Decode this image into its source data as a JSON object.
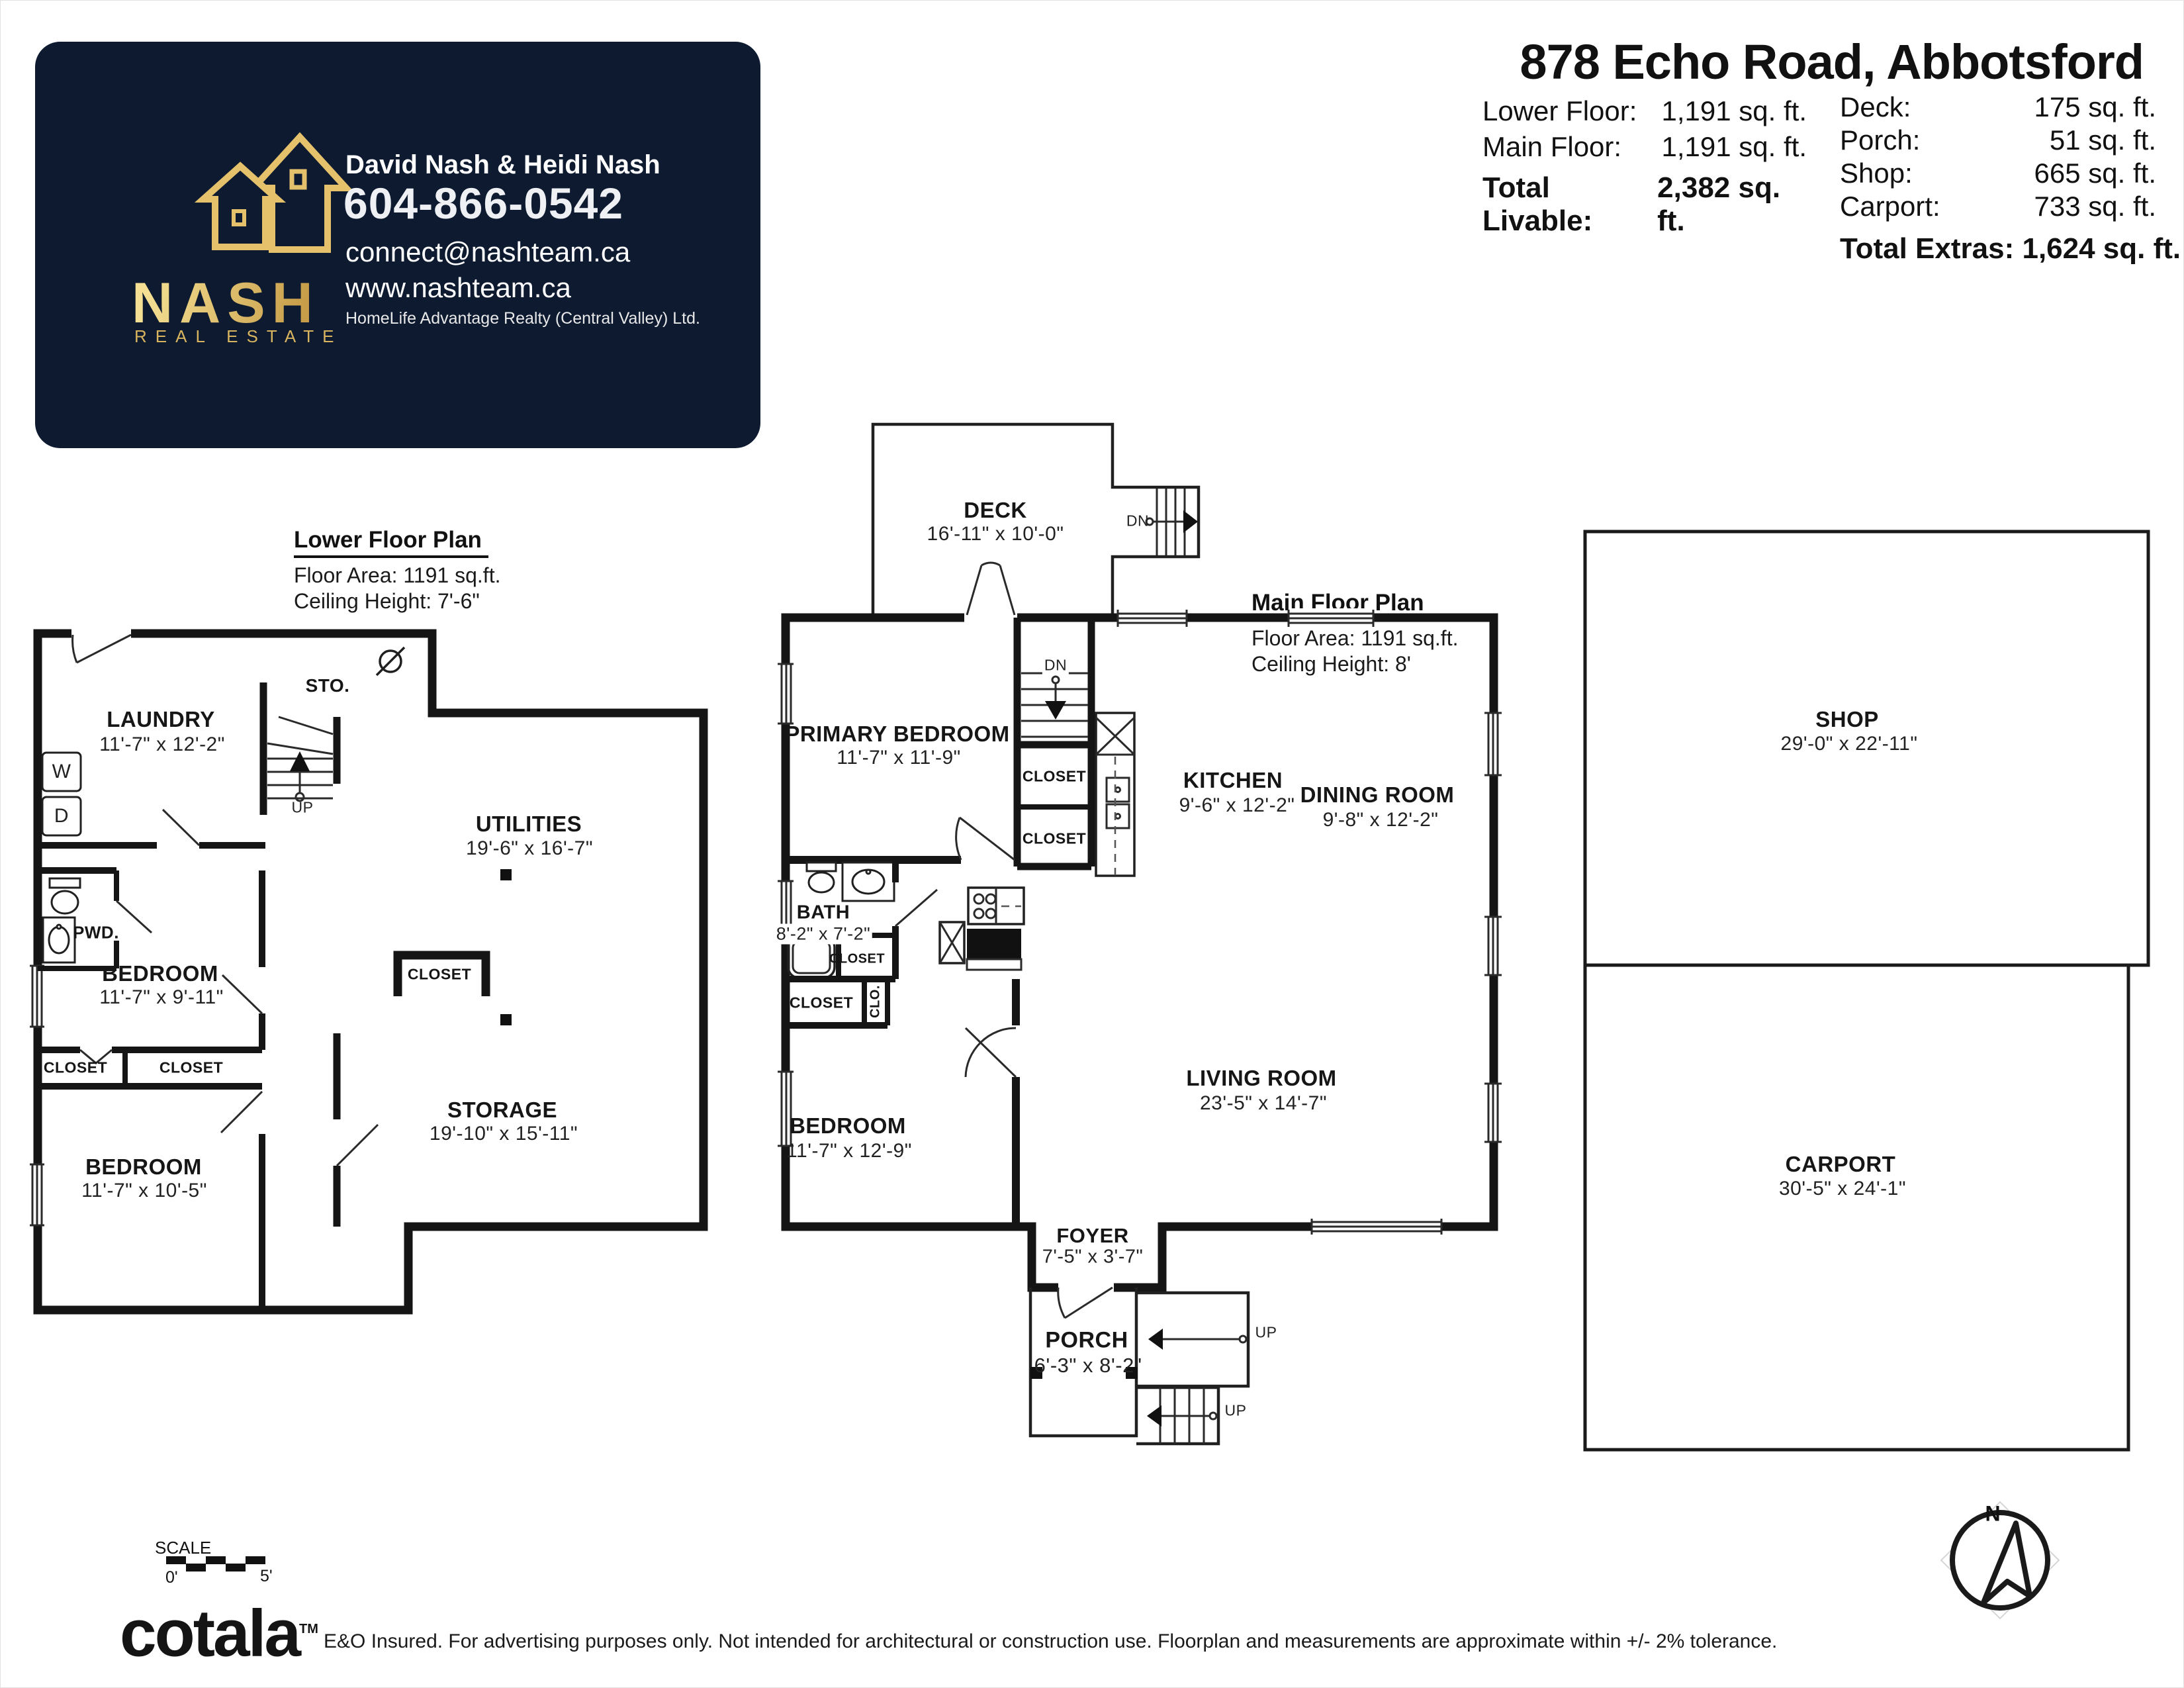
{
  "header": {
    "title": "878 Echo Road, Abbotsford",
    "left_rows": [
      {
        "label": "Lower Floor:",
        "value": "1,191 sq. ft."
      },
      {
        "label": "Main Floor:",
        "value": "1,191 sq. ft."
      }
    ],
    "total_livable_label": "Total Livable:",
    "total_livable_value": "2,382 sq. ft.",
    "right_rows": [
      {
        "label": "Deck:",
        "value": "175 sq. ft."
      },
      {
        "label": "Porch:",
        "value": "51 sq. ft."
      },
      {
        "label": "Shop:",
        "value": "665 sq. ft."
      },
      {
        "label": "Carport:",
        "value": "733 sq. ft."
      }
    ],
    "total_extras": "Total Extras: 1,624 sq. ft."
  },
  "card": {
    "brand": "NASH",
    "brand_sub": "REAL ESTATE",
    "agents": "David Nash & Heidi Nash",
    "phone": "604-866-0542",
    "email": "connect@nashteam.ca",
    "website": "www.nashteam.ca",
    "brokerage": "HomeLife Advantage Realty (Central Valley) Ltd.",
    "bg_color": "#0d1a30",
    "gold_color": "#d9b45f"
  },
  "lower_plan": {
    "title": "Lower Floor Plan",
    "area": "Floor Area: 1191 sq.ft.",
    "ceiling": "Ceiling Height: 7'-6\"",
    "labels": {
      "sto": "STO.",
      "laundry": "LAUNDRY",
      "laundry_dims": "11'-7\" x 12'-2\"",
      "washer": "W",
      "dryer": "D",
      "up": "UP",
      "pwd": "PWD.",
      "bedroom1": "BEDROOM",
      "bedroom1_dims": "11'-7\" x 9'-11\"",
      "closet_left": "CLOSET",
      "closet_right": "CLOSET",
      "bedroom2": "BEDROOM",
      "bedroom2_dims": "11'-7\" x 10'-5\"",
      "utilities": "UTILITIES",
      "utilities_dims": "19'-6\" x 16'-7\"",
      "closet_center": "CLOSET",
      "storage": "STORAGE",
      "storage_dims": "19'-10\" x 15'-11\""
    }
  },
  "main_plan": {
    "title": "Main Floor Plan",
    "area": "Floor Area: 1191 sq.ft.",
    "ceiling": "Ceiling Height: 8'",
    "labels": {
      "deck": "DECK",
      "deck_dims": "16'-11\" x 10'-0\"",
      "dn_deck": "DN",
      "dn_stairs": "DN",
      "primary": "PRIMARY BEDROOM",
      "primary_dims": "11'-7\" x 11'-9\"",
      "closet_upper": "CLOSET",
      "closet_lower": "CLOSET",
      "kitchen": "KITCHEN",
      "kitchen_dims": "9'-6\" x 12'-2\"",
      "dining": "DINING ROOM",
      "dining_dims": "9'-8\" x 12'-2\"",
      "bath": "BATH",
      "bath_dims": "8'-2\" x 7'-2\"",
      "closet_bath": "CLOSET",
      "closet_hall": "CLOSET",
      "clo": "CLO.",
      "bedroom": "BEDROOM",
      "bedroom_dims": "11'-7\" x 12'-9\"",
      "living": "LIVING ROOM",
      "living_dims": "23'-5\" x 14'-7\"",
      "foyer": "FOYER",
      "foyer_dims": "7'-5\" x 3'-7\"",
      "porch": "PORCH",
      "porch_dims": "6'-3\" x 8'-2\"",
      "up_top": "UP",
      "up_bottom": "UP"
    }
  },
  "outbuildings": {
    "shop": "SHOP",
    "shop_dims": "29'-0\" x 22'-11\"",
    "carport": "CARPORT",
    "carport_dims": "30'-5\" x 24'-1\""
  },
  "compass": {
    "north": "N"
  },
  "footer": {
    "scale_label": "SCALE",
    "scale_zero": "0'",
    "scale_five": "5'",
    "logo": "cotala",
    "logo_tm": "TM",
    "disclaimer": "E&O Insured. For advertising purposes only. Not intended for architectural or construction use. Floorplan and measurements are approximate within +/- 2% tolerance."
  }
}
